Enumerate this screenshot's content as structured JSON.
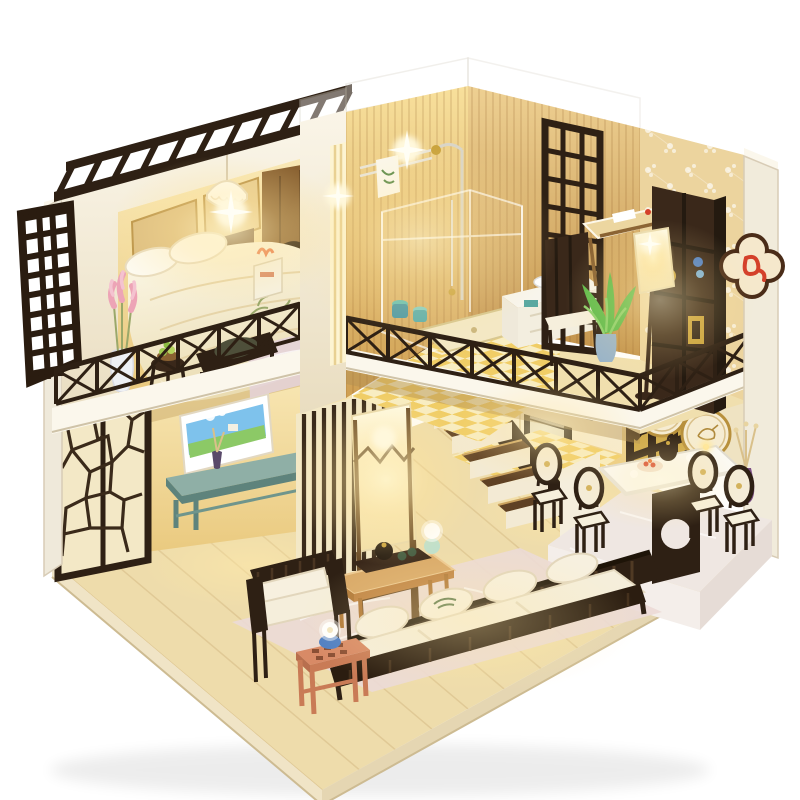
{
  "scene": {
    "subject": "DIY miniature dollhouse kit photographed on a white background: a two-story wooden loft apartment with warm LED lighting, Chinese-style dark lattice screens, a loft bedroom, bathroom, study nook, kitchen, dining platform and living room",
    "background": "#ffffff",
    "style": "cutaway isometric model house, warm interior glow"
  },
  "palette": {
    "bg": "#ffffff",
    "darkwood": "#2e2014",
    "darkwood2": "#4a3016",
    "woodmid": "#8a6232",
    "woodlight": "#d9a968",
    "floor": "#eedcab",
    "cream": "#f4ecd6",
    "creamhi": "#fbf7ec",
    "warmwall": "#f5df9e",
    "white": "#fdfcf8",
    "teal": "#8fafa6",
    "tealdeep": "#5e837c",
    "aqua": "#57a7b0",
    "skyblue": "#7ec2ec",
    "grass": "#8cc966",
    "pinkflower": "#eda4b6",
    "pinkwood": "#d88a66",
    "purple": "#7d4f86",
    "blue": "#4f7fc4",
    "celadon": "#bfe0cc",
    "leafgreen": "#5dbb4a",
    "gold": "#c9a23c",
    "red": "#d4402a",
    "glow": "#ffe9a0",
    "platform": "#efe7e2",
    "rug": "#ecdad6"
  },
  "rooms": {
    "bedroom_loft": {
      "label": "loft bedroom",
      "items": [
        "pergola-slats",
        "lattice-shutter",
        "double-bed",
        "pillows",
        "pendant-lamp",
        "wall-art-panels",
        "wardrobe-with-cat-door",
        "nightstand",
        "foot-bench",
        "fruit-side-table",
        "pink-flower-vase",
        "loft-railing",
        "bedside-rug"
      ]
    },
    "bathroom": {
      "label": "bathroom",
      "items": [
        "plank-walls",
        "shower-set",
        "glass-enclosure",
        "towel-rack",
        "shower-tray",
        "bath-stools",
        "vanity-sink",
        "gold-kettle",
        "checkered-floor"
      ]
    },
    "study_nook": {
      "label": "study nook",
      "items": [
        "lattice-divider",
        "desk",
        "chair",
        "bookshelf",
        "shade-floor-lamp",
        "potted-plant",
        "blossom-wallpaper",
        "balcony-railing",
        "koi-plaque"
      ]
    },
    "kitchen": {
      "label": "kitchen",
      "items": [
        "range-hood",
        "cooktop",
        "oven",
        "sink",
        "cabinets",
        "checkered-floor"
      ]
    },
    "dining": {
      "label": "dining platform",
      "items": [
        "raised-platform",
        "pedestal-table",
        "tea-pot",
        "food-plates",
        "dining-chairs-x4",
        "round-fan-decorations-x2",
        "purple-vase",
        "gold-lattice-window"
      ]
    },
    "living_room": {
      "label": "living room",
      "items": [
        "ice-crack-screens",
        "landscape-painting",
        "tv-bench",
        "incense-burner",
        "bud-vase",
        "zigzag-floor-lamp",
        "slatted-sofa",
        "armchair",
        "coffee-table",
        "tea-tray",
        "celadon-vase",
        "pink-side-stool",
        "blue-bowl",
        "pale-rug",
        "staircase",
        "slat-wall"
      ]
    }
  }
}
